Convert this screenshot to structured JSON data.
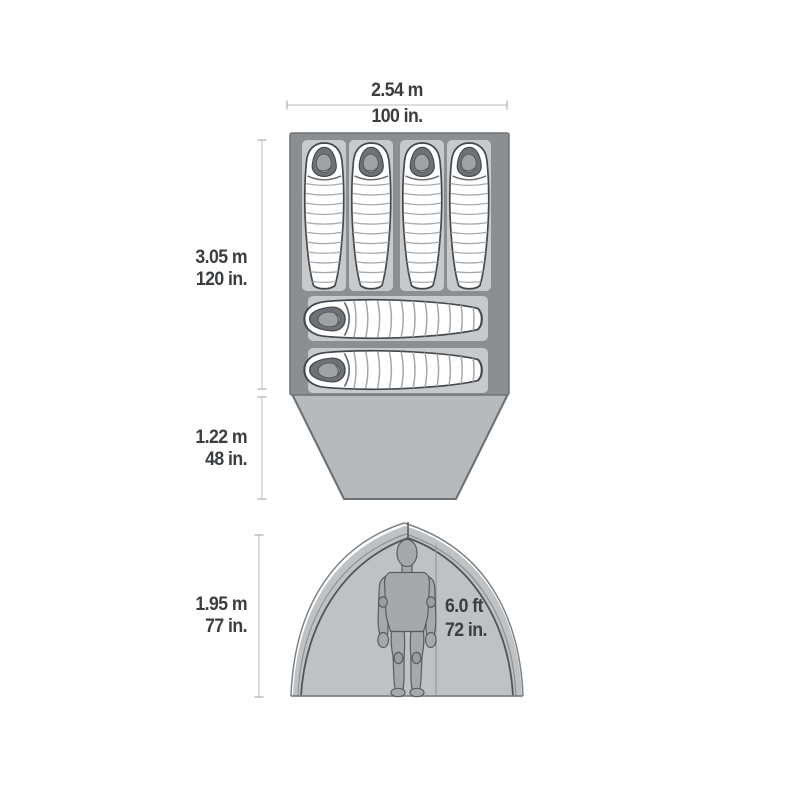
{
  "diagram": {
    "title": "Tent dimensions spec diagram (floor plan and front elevation)",
    "labels": {
      "top_width": {
        "metric": "2.54 m",
        "imperial": "100 in."
      },
      "interior_length": {
        "metric": "3.05 m",
        "imperial": "120 in."
      },
      "vestibule_depth": {
        "metric": "1.22 m",
        "imperial": "48 in."
      },
      "peak_height": {
        "metric": "1.95 m",
        "imperial": "77 in."
      },
      "standing_height": {
        "feet": "6.0 ft",
        "inches": "72 in."
      }
    },
    "floor_plan": {
      "sleeping_bags_vertical_count": 4,
      "sleeping_bags_horizontal_count": 2,
      "sleeping_pads_count": 6
    },
    "front_elevation": {
      "figure": "standing-person"
    },
    "colors": {
      "background": "#ffffff",
      "floor": "#8b8f92",
      "floor_border": "#6f7376",
      "sleeping_pad": "#c7cacc",
      "bag_fill": "#ffffff",
      "bag_outline": "#44484c",
      "bag_baffle": "#a5a9ac",
      "hood_opening": "#6e7276",
      "vestibule": "#b7babc",
      "vestibule_border": "#6b6f72",
      "dome_fill": "#bfc2c4",
      "dome_outline_dark": "#515558",
      "dome_outline_light": "#7e8285",
      "person": "#a6a9ac",
      "person_outline": "#585c60",
      "dim_line": "#c6c9ca",
      "label_text": "#3b3e41"
    }
  }
}
